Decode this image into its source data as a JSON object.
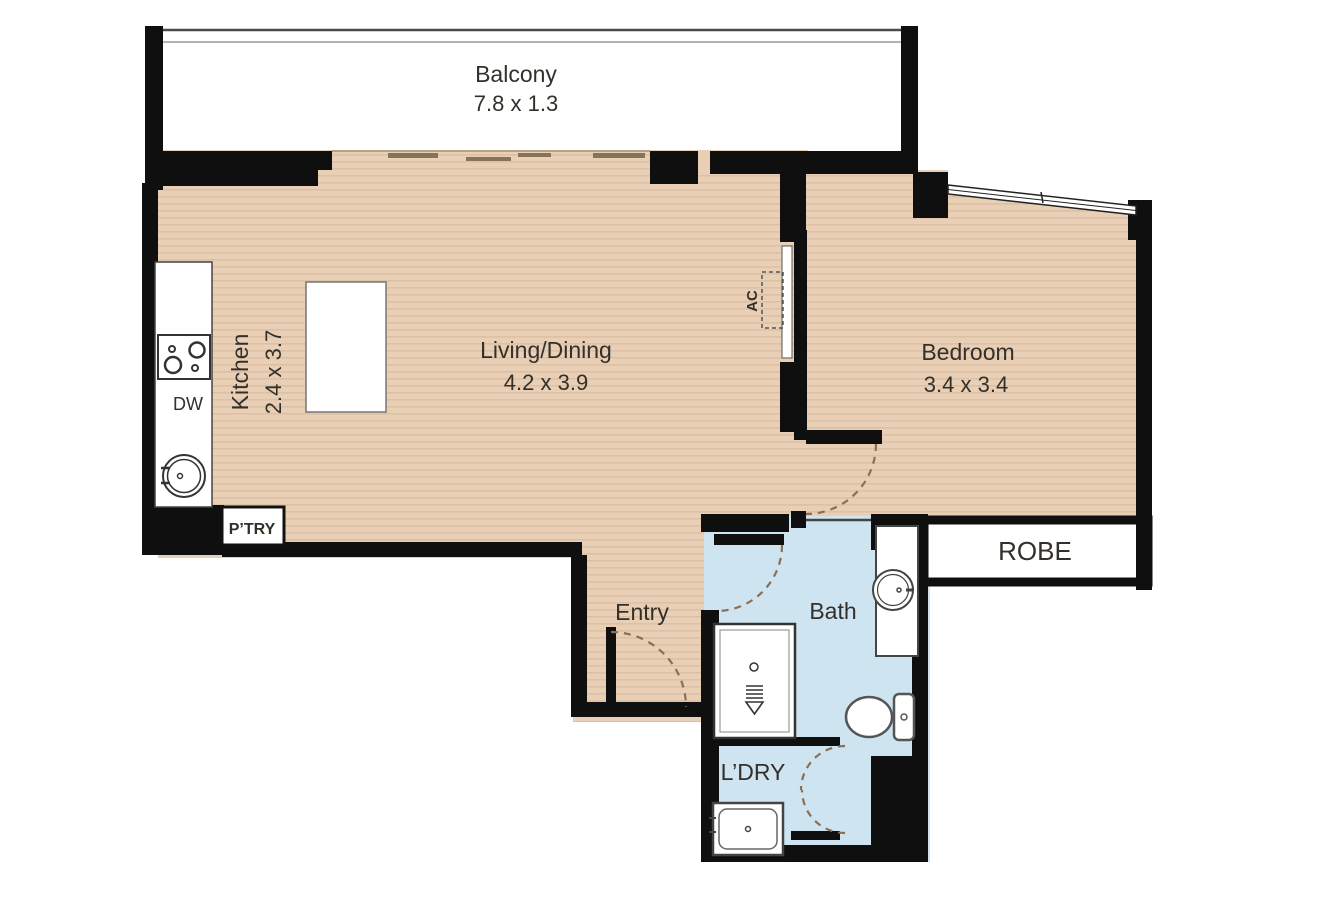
{
  "plan": {
    "title": "One-bedroom apartment floor plan",
    "rooms": {
      "balcony": {
        "label": "Balcony",
        "dims": "7.8 x 1.3"
      },
      "living_dining": {
        "label": "Living/Dining",
        "dims": "4.2 x 3.9"
      },
      "kitchen": {
        "label": "Kitchen",
        "dims": "2.4 x 3.7"
      },
      "bedroom": {
        "label": "Bedroom",
        "dims": "3.4 x 3.4"
      },
      "entry": {
        "label": "Entry"
      },
      "bath": {
        "label": "Bath"
      },
      "laundry": {
        "label": "L’DRY"
      },
      "robe": {
        "label": "ROBE"
      },
      "pantry": {
        "label": "P’TRY"
      }
    },
    "annotations": {
      "ac": "AC",
      "dishwasher": "DW"
    },
    "icons": [
      "cooktop-icon",
      "sink-icon",
      "kitchen-island",
      "kitchen-counter",
      "shower-icon",
      "toilet-icon",
      "basin-icon",
      "vanity",
      "laundry-tub-icon",
      "window-glyph",
      "sliding-door-glyph",
      "balcony-railing",
      "door-swing-arc",
      "bifold-door-arc",
      "ac-unit-outline"
    ],
    "colors": {
      "wall": "#0f0f0f",
      "wood_floor": "#e9cfb5",
      "wood_stripe": "#ddc1a5",
      "wet_floor": "#cfe4f1",
      "door_arc": "#8a6f54",
      "fixture_stroke": "#444444",
      "background": "#ffffff"
    }
  }
}
